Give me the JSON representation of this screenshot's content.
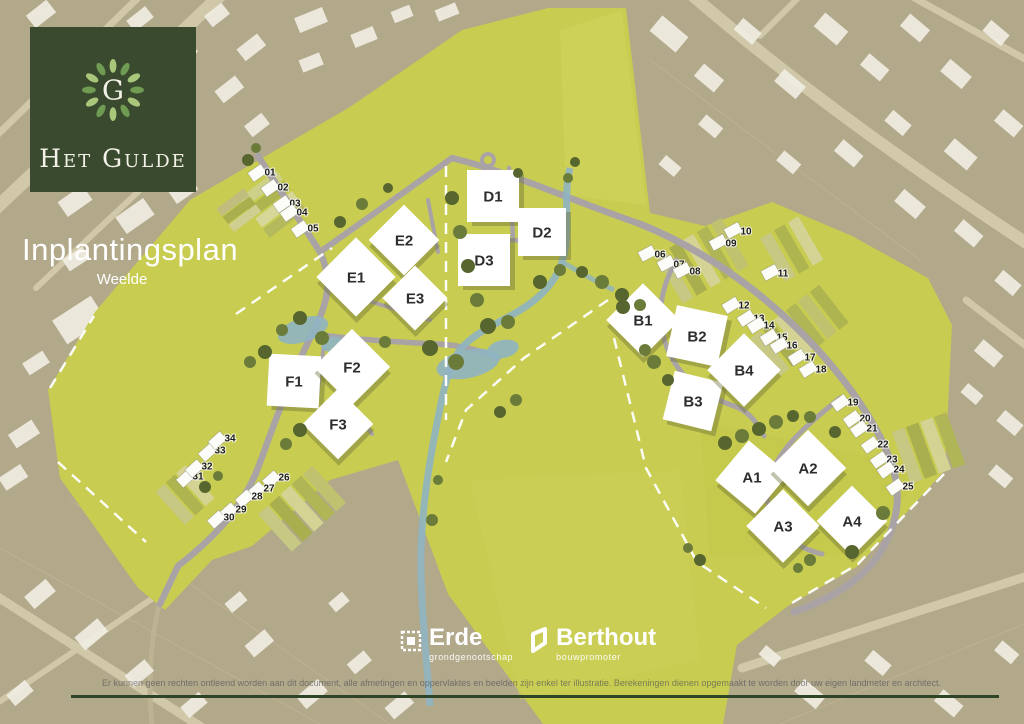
{
  "logo": {
    "initial": "G",
    "brand": "Het Gulde"
  },
  "title": {
    "heading": "Inplantingsplan",
    "subtitle": "Weelde"
  },
  "partners": {
    "erde": {
      "name": "Erde",
      "tagline": "grondgenootschap"
    },
    "berthout": {
      "name": "Berthout",
      "tagline": "bouwpromoter"
    }
  },
  "disclaimer": "Er kunnen geen rechten ontleend worden aan dit document, alle afmetingen en oppervlaktes en beelden zijn enkel ter illustratie. Berekeningen dienen opgemaakt te worden door uw eigen landmeter en architect.",
  "plan": {
    "colors": {
      "development": "#c8cc51",
      "surroundings": "#b2a88a",
      "roads": "#a9a3a6",
      "water": "#8fb4c2",
      "logo_green": "#3a4a2f",
      "rule_green": "#2d4427"
    },
    "blocks": [
      {
        "label": "A1",
        "x": 752,
        "y": 477,
        "size": 52,
        "rot": 40
      },
      {
        "label": "A2",
        "x": 808,
        "y": 468,
        "size": 54,
        "rot": 45
      },
      {
        "label": "A3",
        "x": 783,
        "y": 526,
        "size": 52,
        "rot": 45
      },
      {
        "label": "A4",
        "x": 852,
        "y": 521,
        "size": 50,
        "rot": 45
      },
      {
        "label": "B1",
        "x": 643,
        "y": 320,
        "size": 52,
        "rot": 45
      },
      {
        "label": "B2",
        "x": 697,
        "y": 336,
        "size": 52,
        "rot": 12
      },
      {
        "label": "B3",
        "x": 693,
        "y": 401,
        "size": 50,
        "rot": 14
      },
      {
        "label": "B4",
        "x": 744,
        "y": 370,
        "size": 52,
        "rot": 45
      },
      {
        "label": "D1",
        "x": 493,
        "y": 196,
        "size": 52,
        "rot": 0
      },
      {
        "label": "D2",
        "x": 542,
        "y": 232,
        "size": 48,
        "rot": 0
      },
      {
        "label": "D3",
        "x": 484,
        "y": 260,
        "size": 52,
        "rot": 0
      },
      {
        "label": "E1",
        "x": 356,
        "y": 277,
        "size": 56,
        "rot": 45
      },
      {
        "label": "E2",
        "x": 404,
        "y": 240,
        "size": 50,
        "rot": 45
      },
      {
        "label": "E3",
        "x": 415,
        "y": 298,
        "size": 46,
        "rot": 45
      },
      {
        "label": "F1",
        "x": 294,
        "y": 381,
        "size": 52,
        "rot": 3
      },
      {
        "label": "F2",
        "x": 352,
        "y": 367,
        "size": 54,
        "rot": 45
      },
      {
        "label": "F3",
        "x": 338,
        "y": 424,
        "size": 50,
        "rot": 45
      }
    ],
    "lots": [
      {
        "label": "01",
        "x": 270,
        "y": 172,
        "rot": -35
      },
      {
        "label": "02",
        "x": 283,
        "y": 187,
        "rot": -35
      },
      {
        "label": "03",
        "x": 295,
        "y": 203,
        "rot": -35
      },
      {
        "label": "04",
        "x": 302,
        "y": 212,
        "rot": -35
      },
      {
        "label": "05",
        "x": 313,
        "y": 228,
        "rot": -35
      },
      {
        "label": "06",
        "x": 660,
        "y": 254,
        "rot": -28
      },
      {
        "label": "07",
        "x": 679,
        "y": 264,
        "rot": -28
      },
      {
        "label": "08",
        "x": 695,
        "y": 271,
        "rot": -28
      },
      {
        "label": "09",
        "x": 731,
        "y": 243,
        "rot": -28
      },
      {
        "label": "10",
        "x": 746,
        "y": 231,
        "rot": -28
      },
      {
        "label": "11",
        "x": 783,
        "y": 273,
        "rot": -28
      },
      {
        "label": "12",
        "x": 744,
        "y": 305,
        "rot": -32
      },
      {
        "label": "13",
        "x": 759,
        "y": 318,
        "rot": -32
      },
      {
        "label": "14",
        "x": 769,
        "y": 325,
        "rot": -32
      },
      {
        "label": "15",
        "x": 782,
        "y": 337,
        "rot": -32
      },
      {
        "label": "16",
        "x": 792,
        "y": 345,
        "rot": -32
      },
      {
        "label": "17",
        "x": 810,
        "y": 357,
        "rot": -32
      },
      {
        "label": "18",
        "x": 821,
        "y": 369,
        "rot": -32
      },
      {
        "label": "19",
        "x": 853,
        "y": 402,
        "rot": -35
      },
      {
        "label": "20",
        "x": 865,
        "y": 418,
        "rot": -35
      },
      {
        "label": "21",
        "x": 872,
        "y": 428,
        "rot": -35
      },
      {
        "label": "22",
        "x": 883,
        "y": 444,
        "rot": -35
      },
      {
        "label": "23",
        "x": 892,
        "y": 459,
        "rot": -35
      },
      {
        "label": "24",
        "x": 899,
        "y": 469,
        "rot": -35
      },
      {
        "label": "25",
        "x": 908,
        "y": 486,
        "rot": -35
      },
      {
        "label": "26",
        "x": 284,
        "y": 477,
        "rot": -42
      },
      {
        "label": "27",
        "x": 269,
        "y": 488,
        "rot": -42
      },
      {
        "label": "28",
        "x": 257,
        "y": 496,
        "rot": -42
      },
      {
        "label": "29",
        "x": 241,
        "y": 509,
        "rot": -42
      },
      {
        "label": "30",
        "x": 229,
        "y": 517,
        "rot": -42
      },
      {
        "label": "31",
        "x": 198,
        "y": 476,
        "rot": -42
      },
      {
        "label": "32",
        "x": 207,
        "y": 466,
        "rot": -42
      },
      {
        "label": "33",
        "x": 220,
        "y": 450,
        "rot": -42
      },
      {
        "label": "34",
        "x": 230,
        "y": 438,
        "rot": -42
      }
    ]
  }
}
